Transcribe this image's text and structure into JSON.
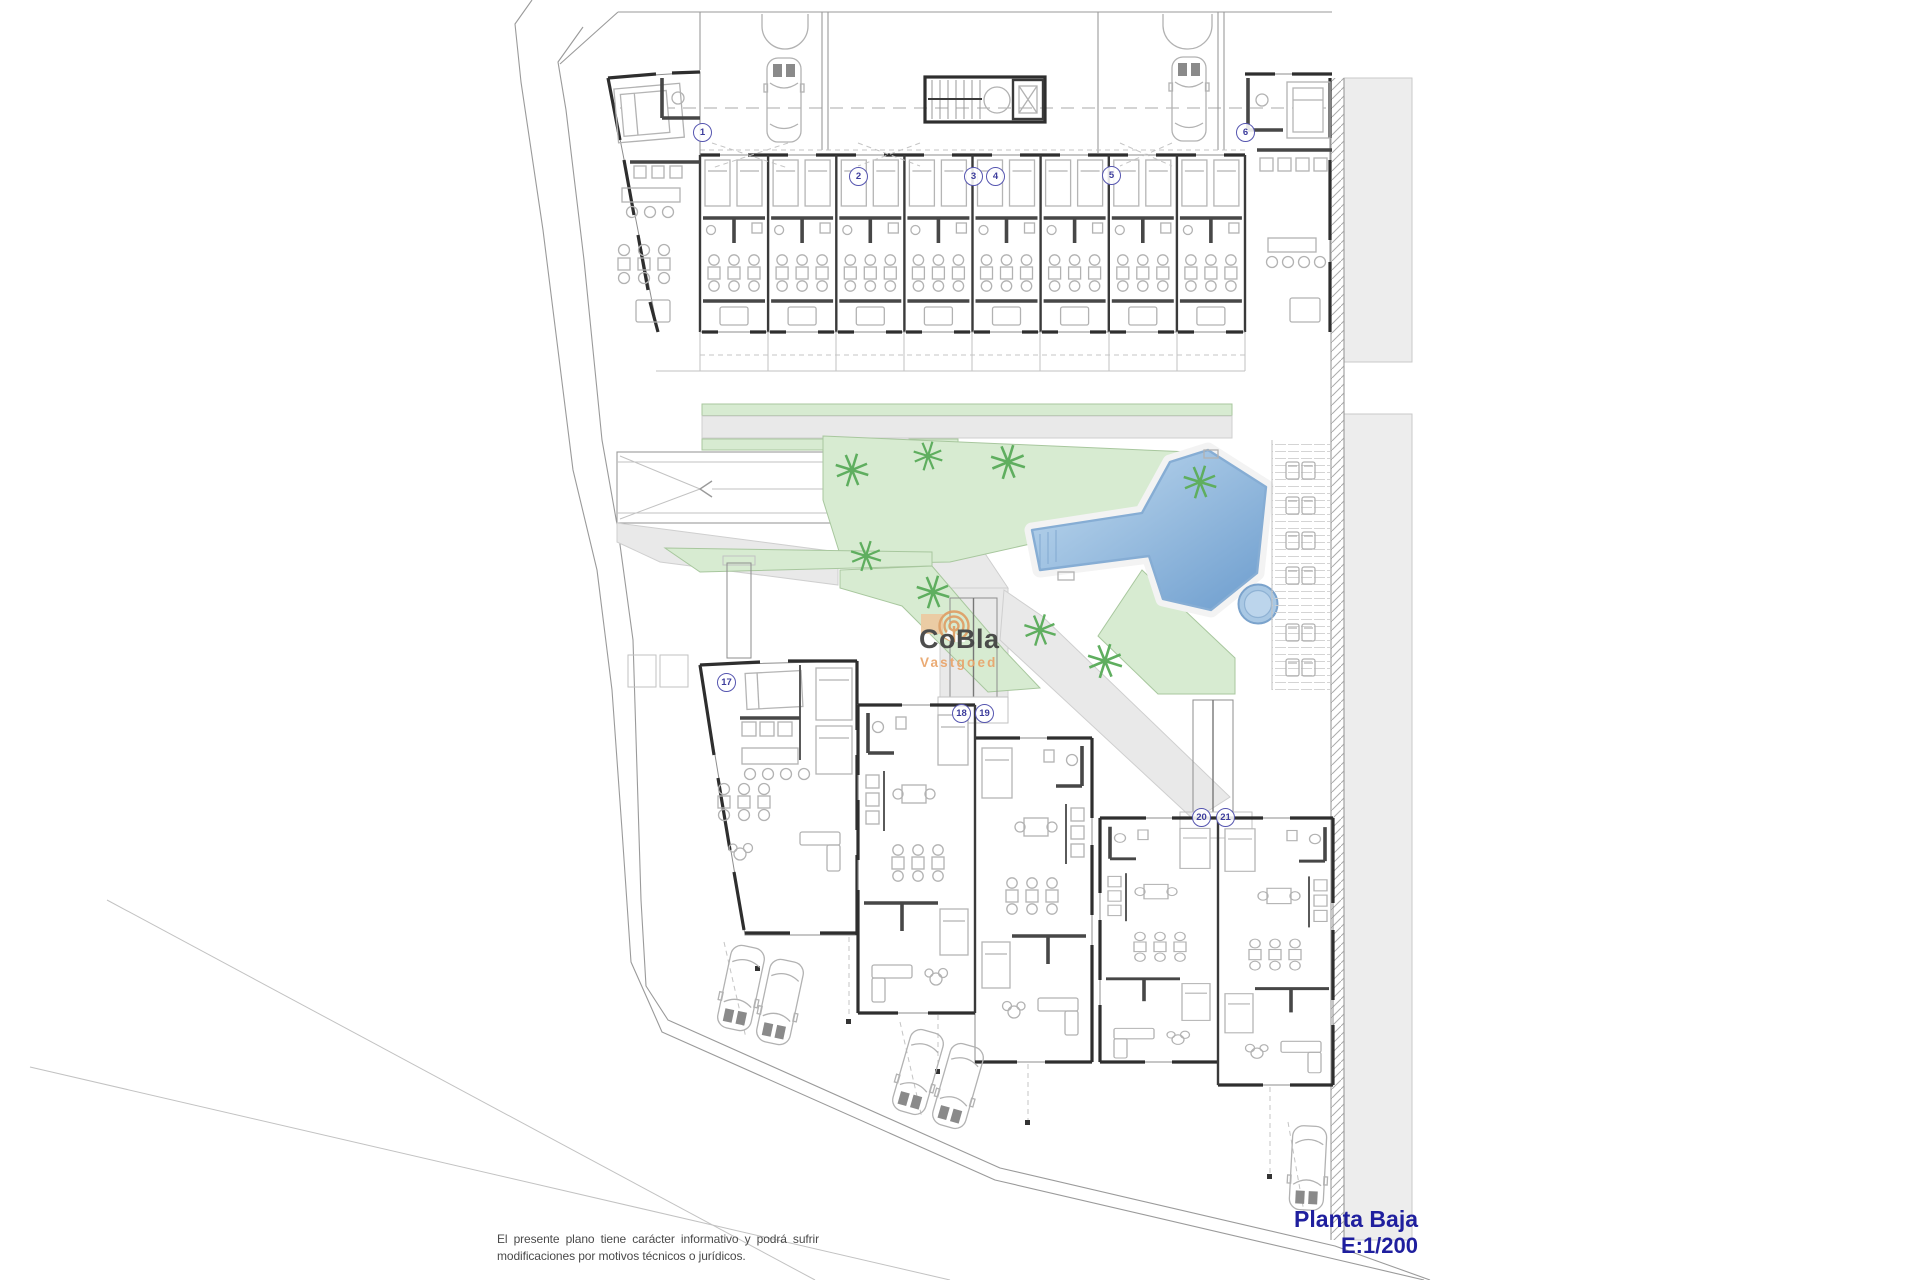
{
  "title_block": {
    "line1": "Planta Baja",
    "line2": "E:1/200"
  },
  "disclaimer": "El presente plano tiene carácter informativo y podrá sufrir modificaciones por motivos técnicos o jurídicos.",
  "logo": {
    "name": "CoBla",
    "tagline": "Vastgoed"
  },
  "units": {
    "top": [
      "1",
      "2",
      "3",
      "4",
      "5",
      "6"
    ],
    "bottom": [
      "17",
      "18",
      "19",
      "20",
      "21"
    ]
  },
  "colors": {
    "title_text": "#1f1f9e",
    "disclaimer_text": "#4a4a4a",
    "logo_name": "#414141",
    "logo_tagline": "#e9a56b",
    "badge_blue": "#3c3c9c",
    "lawn_green": "#d7ebd1",
    "pool_light": "#c3dcf0",
    "pool_dark": "#6d9dce",
    "path_gray": "#e9e9e9",
    "wall_dark": "#2e2e2e",
    "furniture_gray": "#b5b5b5"
  },
  "icons": [
    "car-icon",
    "palm-tree-icon",
    "swimming-pool",
    "jacuzzi-icon",
    "staircase-icon",
    "elevator-icon",
    "sun-lounger-icon",
    "ramp-arrow-icon",
    "garage-door-icon"
  ]
}
